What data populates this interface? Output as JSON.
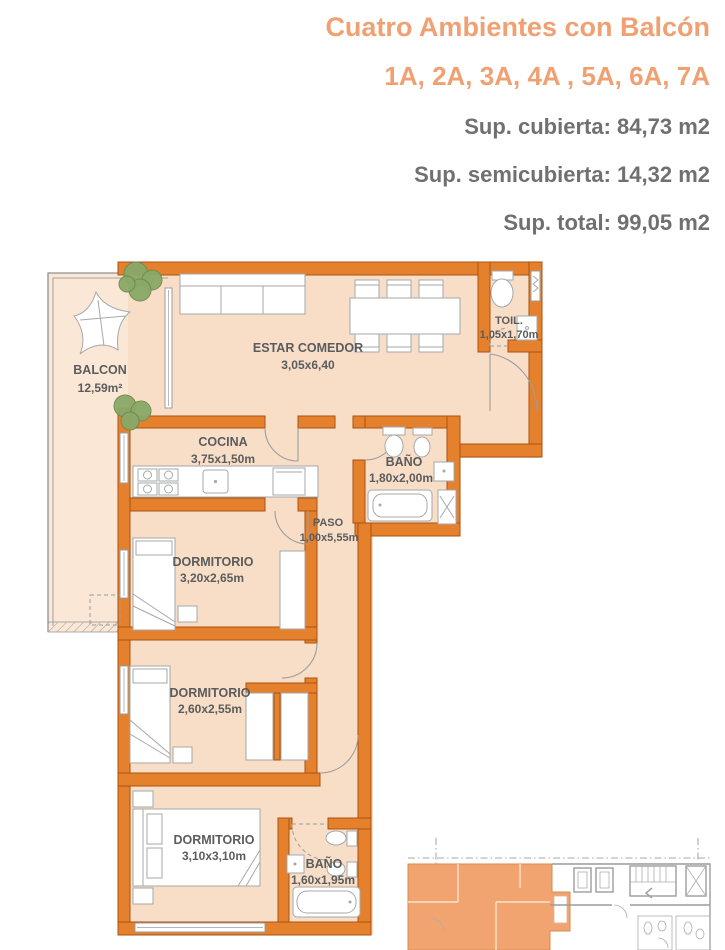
{
  "header": {
    "title": "Cuatro Ambientes con Balcón",
    "units_line": "1A, 2A, 3A, 4A , 5A, 6A, 7A",
    "sup_cubierta": "Sup. cubierta: 84,73 m2",
    "sup_semicubierta": "Sup. semicubierta: 14,32 m2",
    "sup_total": "Sup. total: 99,05 m2"
  },
  "plan": {
    "rooms": [
      {
        "name": "BALCON",
        "dims": "12,59m²"
      },
      {
        "name": "ESTAR COMEDOR",
        "dims": "3,05x6,40"
      },
      {
        "name": "TOIL.",
        "dims": "1,05x1,70m"
      },
      {
        "name": "COCINA",
        "dims": "3,75x1,50m"
      },
      {
        "name": "BAÑO",
        "dims": "1,80x2,00m"
      },
      {
        "name": "PASO",
        "dims": "1,00x5,55m"
      },
      {
        "name": "DORMITORIO",
        "dims": "3,20x2,65m"
      },
      {
        "name": "DORMITORIO",
        "dims": "2,60x2,55m"
      },
      {
        "name": "DORMITORIO",
        "dims": "3,10x3,10m"
      },
      {
        "name": "BAÑO",
        "dims": "1,60x1,95m"
      }
    ]
  },
  "colors": {
    "accent_orange": "#F0A173",
    "wall_orange": "#E5812D",
    "wall_border": "#A95312",
    "floor_peach": "#F8DEC6",
    "balcony_peach": "#FAE7D5",
    "text_gray": "#6E7072",
    "label_gray": "#5A5C5E",
    "plant_green": "#8AA968",
    "keyplan_unit": "#F1A470"
  }
}
